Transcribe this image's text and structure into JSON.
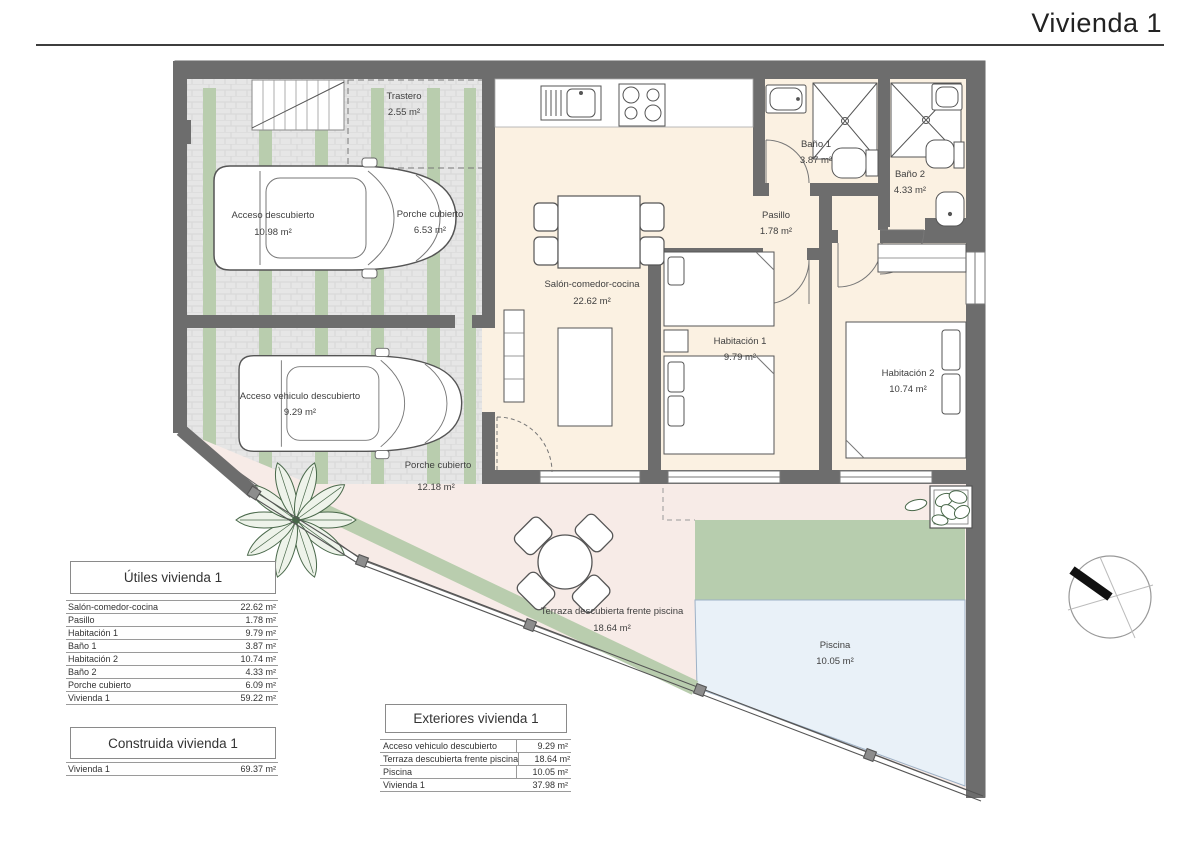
{
  "title": "Vivienda 1",
  "plan": {
    "rooms": [
      {
        "label": "Trastero",
        "area": "2.55 m²"
      },
      {
        "label": "Acceso descubierto",
        "area": "10.98 m²"
      },
      {
        "label": "Porche cubierto",
        "area": "6.53 m²"
      },
      {
        "label": "Salón-comedor-cocina",
        "area": "22.62 m²"
      },
      {
        "label": "Baño 1",
        "area": "3.87 m²"
      },
      {
        "label": "Baño 2",
        "area": "4.33 m²"
      },
      {
        "label": "Pasillo",
        "area": "1.78 m²"
      },
      {
        "label": "Habitación 1",
        "area": "9.79 m²"
      },
      {
        "label": "Habitación 2",
        "area": "10.74 m²"
      },
      {
        "label": "Acceso vehiculo descubierto",
        "area": "9.29 m²"
      },
      {
        "label": "Porche cubierto",
        "area": "12.18 m²"
      },
      {
        "label": "Terraza descubierta frente piscina",
        "area": "18.64 m²"
      },
      {
        "label": "Piscina",
        "area": "10.05 m²"
      }
    ]
  },
  "tables": {
    "utiles": {
      "title": "Útiles vivienda 1",
      "rows": [
        {
          "label": "Salón-comedor-cocina",
          "value": "22.62 m²"
        },
        {
          "label": "Pasillo",
          "value": "1.78 m²"
        },
        {
          "label": "Habitación 1",
          "value": "9.79 m²"
        },
        {
          "label": "Baño 1",
          "value": "3.87 m²"
        },
        {
          "label": "Habitación 2",
          "value": "10.74 m²"
        },
        {
          "label": "Baño 2",
          "value": "4.33 m²"
        },
        {
          "label": "Porche cubierto",
          "value": "6.09 m²"
        },
        {
          "label": "Vivienda 1",
          "value": "59.22 m²"
        }
      ]
    },
    "construida": {
      "title": "Construida vivienda 1",
      "rows": [
        {
          "label": "Vivienda 1",
          "value": "69.37 m²"
        }
      ]
    },
    "exteriores": {
      "title": "Exteriores vivienda 1",
      "rows": [
        {
          "label": "Acceso vehiculo descubierto",
          "value": "9.29 m²"
        },
        {
          "label": "Terraza descubierta frente piscina",
          "value": "18.64 m²"
        },
        {
          "label": "Piscina",
          "value": "10.05 m²"
        },
        {
          "label": "Vivienda 1",
          "value": "37.98 m²"
        }
      ]
    }
  },
  "colors": {
    "wall": "#6d6d6d",
    "interior_floor": "#fbf1e2",
    "terrace": "#f7ebe7",
    "lawn": "#b7cdae",
    "pool": "#e9f1f8",
    "paving": "#e6e6e6",
    "green_stripe": "#b9cdae"
  }
}
